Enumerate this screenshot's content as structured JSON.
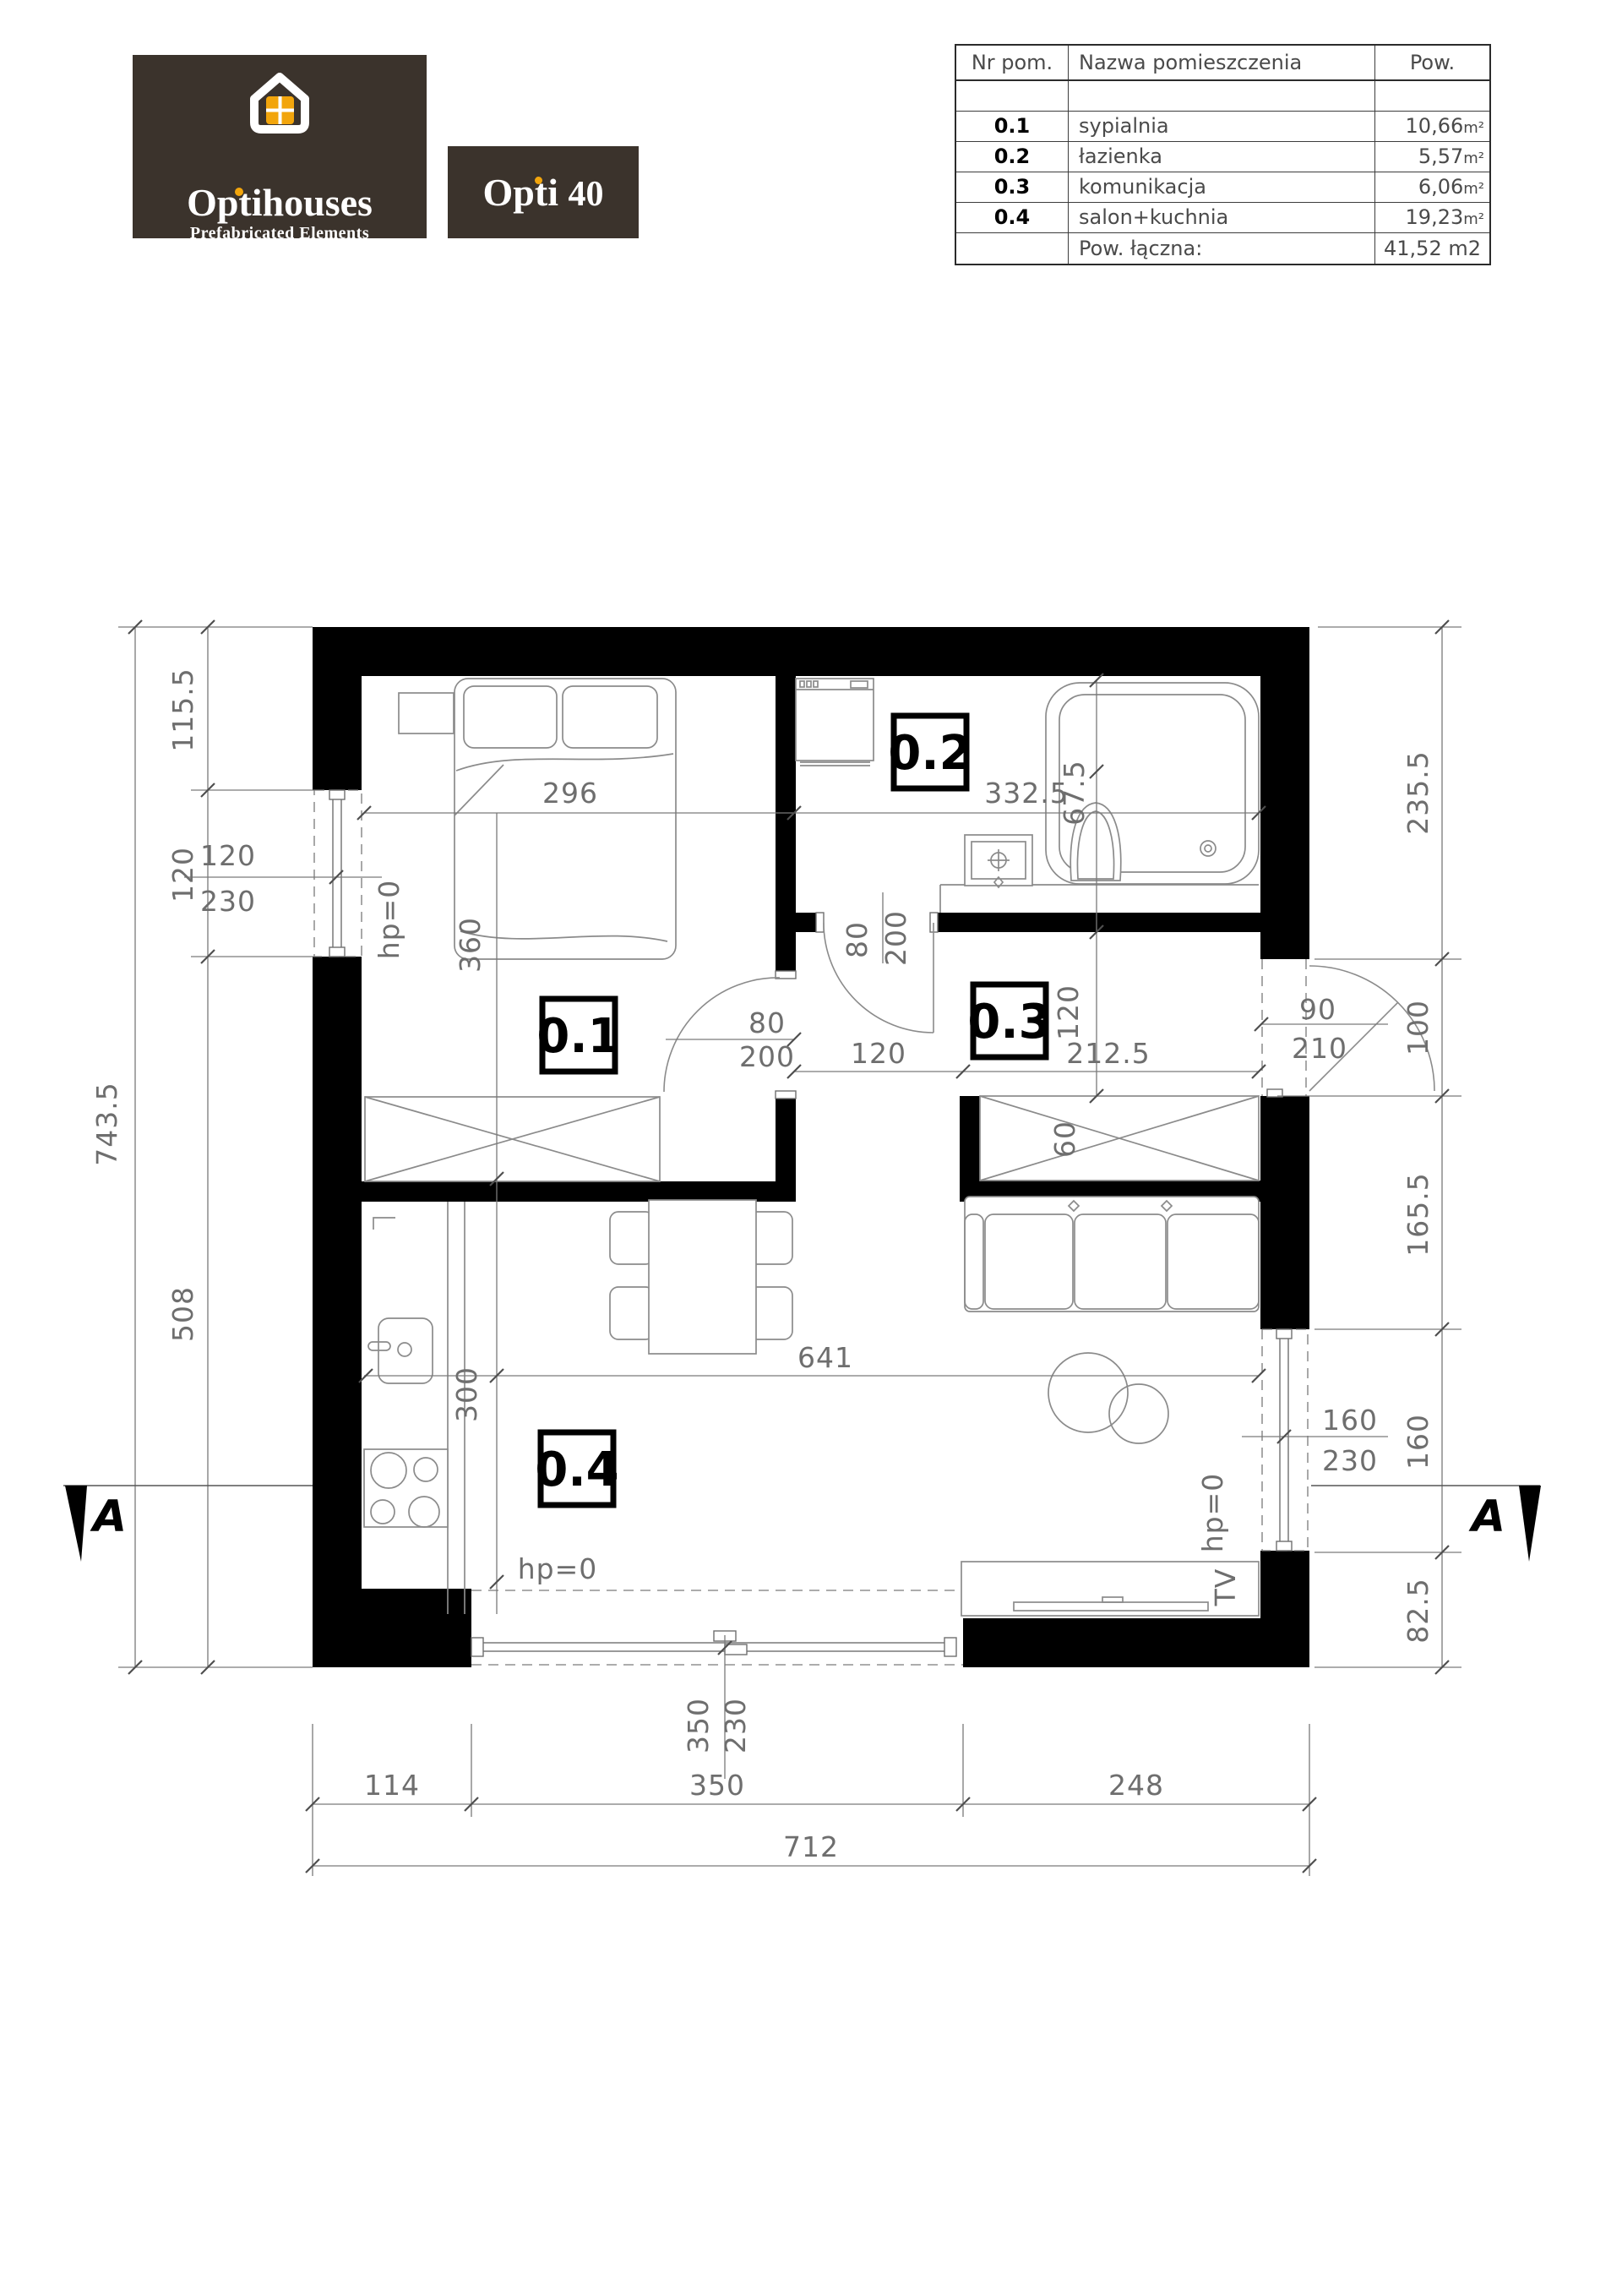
{
  "logo": {
    "brand": "Optihouses",
    "tagline": "Prefabricated Elements",
    "model": "Opti",
    "number": "40"
  },
  "table": {
    "col_nr": "Nr pom.",
    "col_name": "Nazwa pomieszczenia",
    "col_area": "Pow.",
    "rows": [
      {
        "nr": "0.1",
        "name": "sypialnia",
        "area": "10,66",
        "unit": "m²"
      },
      {
        "nr": "0.2",
        "name": "łazienka",
        "area": "5,57",
        "unit": "m²"
      },
      {
        "nr": "0.3",
        "name": "komunikacja",
        "area": "6,06",
        "unit": "m²"
      },
      {
        "nr": "0.4",
        "name": "salon+kuchnia",
        "area": "19,23",
        "unit": "m²"
      }
    ],
    "total_label": "Pow. łączna:",
    "total_value": "41,52 m2"
  },
  "plan": {
    "rooms": {
      "bedroom": "0.1",
      "bathroom": "0.2",
      "corridor": "0.3",
      "living": "0.4"
    },
    "dims": {
      "left": {
        "total": "743.5",
        "top": "115.5",
        "window": "120",
        "bottom": "508"
      },
      "left_window": {
        "w": "120",
        "h": "230"
      },
      "right": {
        "top": "235.5",
        "door": "100",
        "middle": "165.5",
        "window": "160",
        "bottom": "82.5"
      },
      "entry_door": {
        "w": "90",
        "h": "210"
      },
      "right_window": {
        "w": "160",
        "h": "230"
      },
      "south_window": {
        "w": "350",
        "h": "230"
      },
      "bottom": {
        "s1": "114",
        "s2": "350",
        "s3": "248",
        "total": "712"
      },
      "bedroom": {
        "width": "296",
        "bed": "360"
      },
      "bathroom": {
        "width": "332.5",
        "toilet": "67.5"
      },
      "bedroom_door": {
        "w": "80",
        "h": "200"
      },
      "bath_door": {
        "w": "80",
        "h": "200"
      },
      "corridor": {
        "width": "212.5",
        "passage": "120",
        "height": "120",
        "wardrobe": "60"
      },
      "living": {
        "width": "641",
        "depth": "300"
      },
      "hp": "hp=0"
    },
    "annotations": {
      "tv": "TV",
      "section": "A"
    }
  }
}
